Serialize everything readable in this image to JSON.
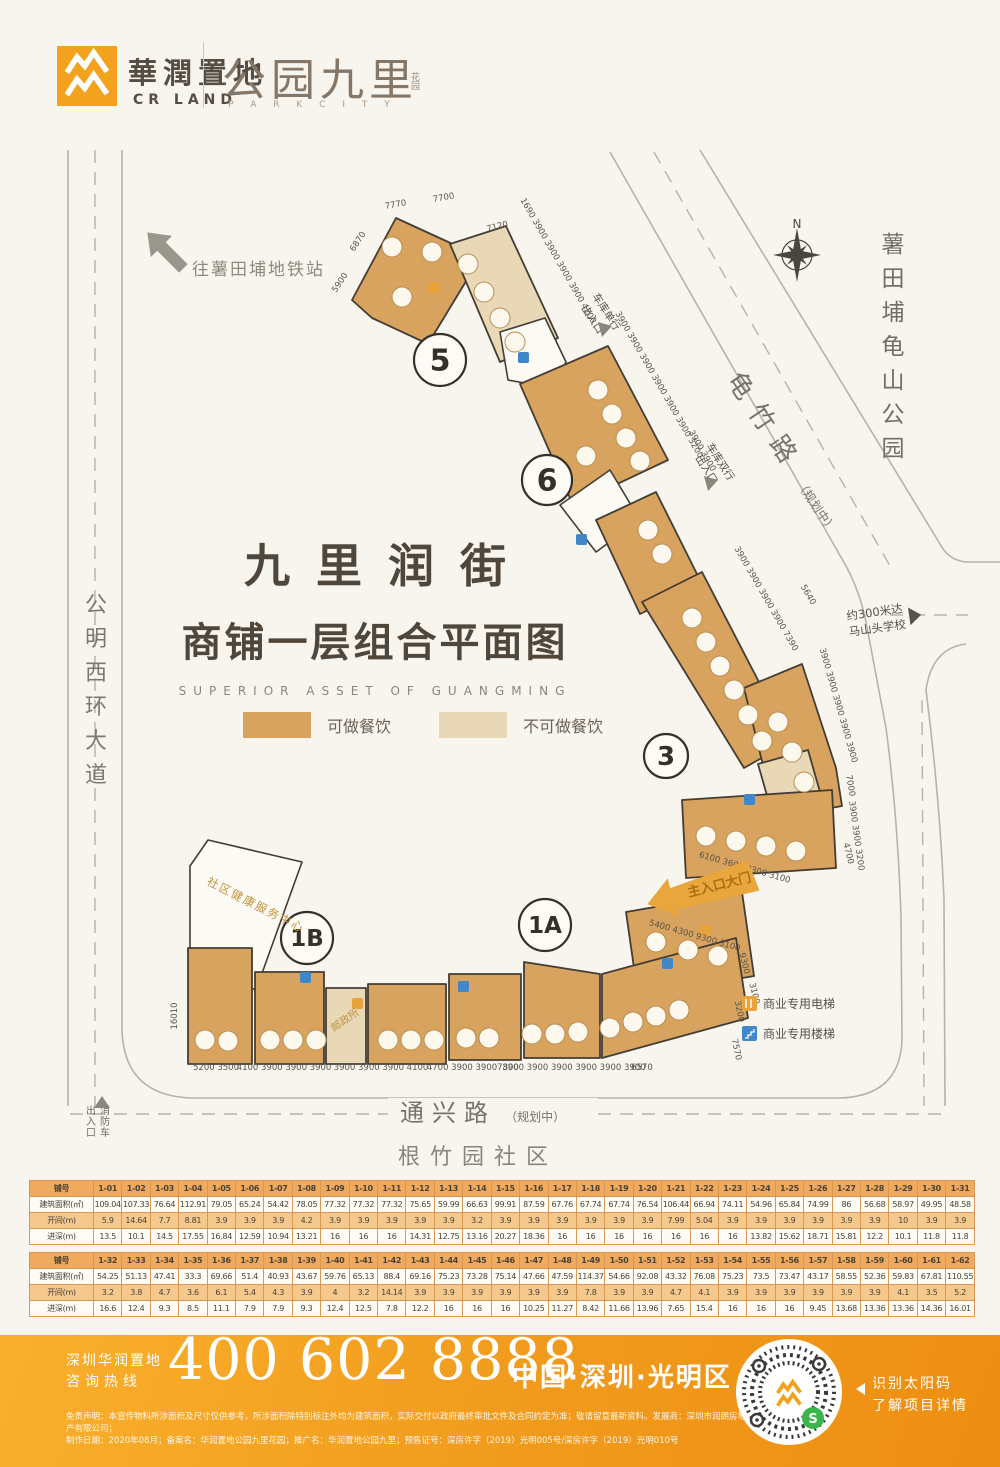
{
  "header": {
    "brand_cn": "華潤置地",
    "brand_en": "CR LAND",
    "project_name": "公园九里",
    "project_seal": "花园",
    "project_en": "P A R K C I T Y"
  },
  "map": {
    "metro_label": "往薯田埔地铁站",
    "title": "九里润街",
    "subtitle": "商铺一层组合平面图",
    "subtitle_en": "SUPERIOR ASSET OF GUANGMING",
    "legend": [
      {
        "label": "可做餐饮",
        "color": "#d7a35e"
      },
      {
        "label": "不可做餐饮",
        "color": "#e8d8b6"
      }
    ],
    "compass_n": "N",
    "roads": {
      "left": "公明西环大道",
      "right": "龟竹路",
      "right_sub": "（规划中）",
      "bottom": "通兴路",
      "bottom_sub": "（规划中）",
      "community": "根竹园社区",
      "park": "薯田埔龟山公园"
    },
    "labels": {
      "school_1": "约300米达",
      "school_2": "马山头学校",
      "garage_single_1": "车库单行",
      "garage_single_2": "出入口",
      "garage_double_1": "车库双行",
      "garage_double_2": "出入口",
      "fire_1": "消防车",
      "fire_2": "出入口",
      "main_gate": "主入口大门",
      "community_health": "社区健康服务中心",
      "post_office": "邮政所",
      "elevator": "商业专用电梯",
      "stairs": "商业专用楼梯"
    },
    "zones": [
      {
        "t": "5",
        "x": 440,
        "y": 360,
        "r": 26,
        "f": 30
      },
      {
        "t": "6",
        "x": 547,
        "y": 480,
        "r": 25,
        "f": 30
      },
      {
        "t": "3",
        "x": 666,
        "y": 756,
        "r": 22,
        "f": 26
      },
      {
        "t": "1A",
        "x": 545,
        "y": 925,
        "r": 26,
        "f": 23
      },
      {
        "t": "1B",
        "x": 307,
        "y": 938,
        "r": 26,
        "f": 23
      }
    ],
    "dims": [
      {
        "t": "7770",
        "x": 396,
        "y": 207,
        "r": -10
      },
      {
        "t": "7700",
        "x": 444,
        "y": 200,
        "r": -10
      },
      {
        "t": "6870",
        "x": 360,
        "y": 243,
        "r": -56
      },
      {
        "t": "5900",
        "x": 342,
        "y": 284,
        "r": -56
      },
      {
        "t": "7120",
        "x": 498,
        "y": 229,
        "r": -15
      },
      {
        "t": "1690 3900 3900 3900 3900 4200",
        "x": 556,
        "y": 262,
        "r": 60
      },
      {
        "t": "3900 3900 3900 3900 3900 3900 3200",
        "x": 657,
        "y": 386,
        "r": 60
      },
      {
        "t": "3900 3900",
        "x": 700,
        "y": 452,
        "r": 60
      },
      {
        "t": "3900 3900 3900 3900 7390",
        "x": 764,
        "y": 600,
        "r": 60
      },
      {
        "t": "5640",
        "x": 806,
        "y": 596,
        "r": 60
      },
      {
        "t": "3900 3900 3900 3900 3900",
        "x": 836,
        "y": 706,
        "r": 74
      },
      {
        "t": "7000",
        "x": 848,
        "y": 786,
        "r": 80
      },
      {
        "t": "3900 3900 3200",
        "x": 854,
        "y": 836,
        "r": 82
      },
      {
        "t": "6100 3600 9300 3100",
        "x": 744,
        "y": 870,
        "r": 16
      },
      {
        "t": "4700",
        "x": 846,
        "y": 854,
        "r": 76
      },
      {
        "t": "5400 4300 9300 3100",
        "x": 694,
        "y": 938,
        "r": 16
      },
      {
        "t": "9300",
        "x": 742,
        "y": 964,
        "r": 76
      },
      {
        "t": "3100",
        "x": 752,
        "y": 994,
        "r": 76
      },
      {
        "t": "16010",
        "x": 177,
        "y": 1016,
        "r": -90
      },
      {
        "t": "5200 3500",
        "x": 216,
        "y": 1070,
        "r": 0
      },
      {
        "t": "4100 3900 3900 3900",
        "x": 284,
        "y": 1070,
        "r": 0
      },
      {
        "t": "3900 3900 3900 4100",
        "x": 381,
        "y": 1070,
        "r": 0
      },
      {
        "t": "4700 3900 3900",
        "x": 462,
        "y": 1070,
        "r": 0
      },
      {
        "t": "7800",
        "x": 508,
        "y": 1070,
        "r": 0
      },
      {
        "t": "3900 3900 3900 3900 3900 3900",
        "x": 574,
        "y": 1070,
        "r": 0
      },
      {
        "t": "6570",
        "x": 642,
        "y": 1070,
        "r": 0
      },
      {
        "t": "3200",
        "x": 737,
        "y": 1012,
        "r": 78
      },
      {
        "t": "7570",
        "x": 734,
        "y": 1050,
        "r": 78
      }
    ],
    "vtexts": [
      {
        "t": "公明西环大道",
        "x": 96,
        "y": 612,
        "s": 22,
        "g": 34,
        "c": "#7d776d"
      },
      {
        "t": "薯田埔龟山公园",
        "x": 893,
        "y": 252,
        "s": 23,
        "g": 34,
        "c": "#746e64"
      },
      {
        "t": "消防车",
        "x": 105,
        "y": 1114,
        "s": 10,
        "g": 11,
        "c": "#6f6a62"
      },
      {
        "t": "出入口",
        "x": 91,
        "y": 1114,
        "s": 10,
        "g": 11,
        "c": "#6f6a62"
      }
    ],
    "unit_circles": [
      [
        392,
        247
      ],
      [
        432,
        252
      ],
      [
        402,
        297
      ],
      [
        468,
        264
      ],
      [
        484,
        292
      ],
      [
        500,
        318
      ],
      [
        515,
        342
      ],
      [
        598,
        390
      ],
      [
        612,
        414
      ],
      [
        626,
        438
      ],
      [
        640,
        461
      ],
      [
        586,
        456
      ],
      [
        648,
        530
      ],
      [
        662,
        554
      ],
      [
        692,
        618
      ],
      [
        706,
        642
      ],
      [
        720,
        666
      ],
      [
        734,
        690
      ],
      [
        748,
        715
      ],
      [
        762,
        741
      ],
      [
        778,
        722
      ],
      [
        792,
        752
      ],
      [
        804,
        782
      ],
      [
        706,
        836
      ],
      [
        736,
        841
      ],
      [
        766,
        846
      ],
      [
        796,
        851
      ],
      [
        656,
        942
      ],
      [
        688,
        950
      ],
      [
        718,
        956
      ],
      [
        205,
        1040
      ],
      [
        228,
        1041
      ],
      [
        270,
        1040
      ],
      [
        293,
        1040
      ],
      [
        316,
        1040
      ],
      [
        388,
        1040
      ],
      [
        411,
        1040
      ],
      [
        434,
        1040
      ],
      [
        466,
        1038
      ],
      [
        489,
        1038
      ],
      [
        532,
        1034
      ],
      [
        555,
        1034
      ],
      [
        578,
        1032
      ],
      [
        610,
        1028
      ],
      [
        633,
        1022
      ],
      [
        656,
        1016
      ],
      [
        679,
        1010
      ]
    ],
    "icons": [
      {
        "k": "e",
        "x": 428,
        "y": 282
      },
      {
        "k": "s",
        "x": 518,
        "y": 352
      },
      {
        "k": "s",
        "x": 576,
        "y": 534
      },
      {
        "k": "s",
        "x": 744,
        "y": 794
      },
      {
        "k": "e",
        "x": 352,
        "y": 998
      },
      {
        "k": "s",
        "x": 458,
        "y": 981
      },
      {
        "k": "s",
        "x": 300,
        "y": 972
      },
      {
        "k": "e",
        "x": 700,
        "y": 925
      },
      {
        "k": "s",
        "x": 662,
        "y": 958
      }
    ],
    "icon_colors": {
      "e": "#e8a33d",
      "s": "#3f87c8"
    }
  },
  "tables": [
    {
      "row_headers": [
        "铺号",
        "建筑面积(㎡)",
        "开间(m)",
        "进深(m)"
      ],
      "units": [
        "1-01",
        "1-02",
        "1-03",
        "1-04",
        "1-05",
        "1-06",
        "1-07",
        "1-08",
        "1-09",
        "1-10",
        "1-11",
        "1-12",
        "1-13",
        "1-14",
        "1-15",
        "1-16",
        "1-17",
        "1-18",
        "1-19",
        "1-20",
        "1-21",
        "1-22",
        "1-23",
        "1-24",
        "1-25",
        "1-26",
        "1-27",
        "1-28",
        "1-29",
        "1-30",
        "1-31"
      ],
      "area": [
        109.04,
        107.33,
        76.64,
        112.91,
        79.05,
        65.24,
        54.42,
        78.05,
        77.32,
        77.32,
        77.32,
        75.65,
        59.99,
        66.63,
        99.91,
        87.59,
        67.76,
        67.74,
        67.74,
        76.54,
        106.44,
        66.94,
        74.11,
        54.96,
        65.84,
        74.99,
        86,
        56.68,
        58.97,
        49.95,
        48.58
      ],
      "width": [
        5.9,
        14.64,
        7.7,
        8.81,
        3.9,
        3.9,
        3.9,
        4.2,
        3.9,
        3.9,
        3.9,
        3.9,
        3.9,
        3.2,
        3.9,
        3.9,
        3.9,
        3.9,
        3.9,
        3.9,
        7.99,
        5.04,
        3.9,
        3.9,
        3.9,
        3.9,
        3.9,
        3.9,
        10,
        3.9,
        3.9
      ],
      "depth": [
        13.5,
        10.1,
        14.5,
        17.55,
        16.84,
        12.59,
        10.94,
        13.21,
        16,
        16,
        16,
        14.31,
        12.75,
        13.16,
        20.27,
        18.36,
        16,
        16,
        16,
        16,
        16,
        16,
        16,
        13.82,
        15.62,
        18.71,
        15.81,
        12.2,
        10.1,
        11.8,
        11.8
      ]
    },
    {
      "row_headers": [
        "铺号",
        "建筑面积(㎡)",
        "开间(m)",
        "进深(m)"
      ],
      "units": [
        "1-32",
        "1-33",
        "1-34",
        "1-35",
        "1-36",
        "1-37",
        "1-38",
        "1-39",
        "1-40",
        "1-41",
        "1-42",
        "1-43",
        "1-44",
        "1-45",
        "1-46",
        "1-47",
        "1-48",
        "1-49",
        "1-50",
        "1-51",
        "1-52",
        "1-53",
        "1-54",
        "1-55",
        "1-56",
        "1-57",
        "1-58",
        "1-59",
        "1-60",
        "1-61",
        "1-62"
      ],
      "area": [
        54.25,
        51.13,
        47.41,
        33.3,
        69.66,
        51.4,
        40.93,
        43.67,
        59.76,
        65.13,
        88.4,
        69.16,
        75.23,
        73.28,
        75.14,
        47.66,
        47.59,
        114.37,
        54.66,
        92.08,
        43.32,
        76.08,
        75.23,
        73.5,
        73.47,
        43.17,
        58.55,
        52.36,
        59.83,
        67.81,
        110.55
      ],
      "width": [
        3.2,
        3.8,
        4.7,
        3.6,
        6.1,
        5.4,
        4.3,
        3.9,
        4,
        3.2,
        14.14,
        3.9,
        3.9,
        3.9,
        3.9,
        3.9,
        3.9,
        7.8,
        3.9,
        3.9,
        4.7,
        4.1,
        3.9,
        3.9,
        3.9,
        3.9,
        3.9,
        3.9,
        4.1,
        3.5,
        5.2
      ],
      "depth": [
        16.6,
        12.4,
        9.3,
        8.5,
        11.1,
        7.9,
        7.9,
        9.3,
        12.4,
        12.5,
        7.8,
        12.2,
        16,
        16,
        16,
        10.25,
        11.27,
        8.42,
        11.66,
        13.96,
        7.65,
        15.4,
        16,
        16,
        16,
        9.45,
        13.68,
        13.36,
        13.36,
        14.36,
        16.01
      ]
    }
  ],
  "footer": {
    "hotline_1": "深圳华润置地",
    "hotline_2": "咨询热线",
    "phone": "400 602 8888",
    "location": "中国·深圳·光明区",
    "qr_cap_1": "识别太阳码",
    "qr_cap_2": "了解项目详情",
    "disclaimer_1": "免责声明：本宣传物料所涉面积及尺寸仅供参考，所涉面积除特别标注外均为建筑面积，实际交付以政府最终审批文件及合同约定为准；敬请留意最新资料。发展商：深圳市润朗房地产有限公司；",
    "disclaimer_2": "制作日期：2020年08月；备案名：华润置地公园九里花园；推广名：华润置地公园九里；预售证号：深房许字（2019）光明005号/深房许字（2019）光明010号"
  }
}
